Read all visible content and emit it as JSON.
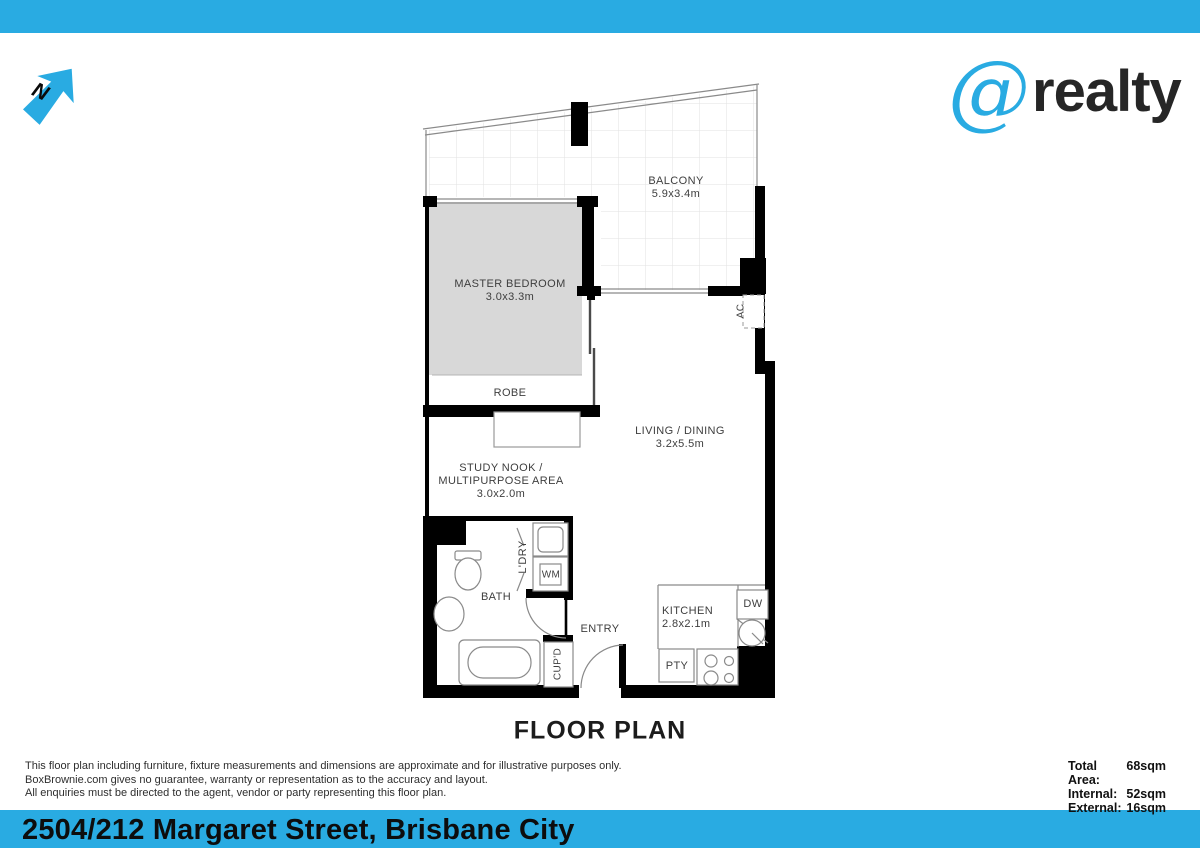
{
  "colors": {
    "brand": "#29abe2",
    "bedroom_fill": "#d8d8d8",
    "wall": "#000000"
  },
  "header": {
    "north_label": "N",
    "logo_at": "@",
    "logo_name": "realty"
  },
  "plan": {
    "title": "FLOOR PLAN",
    "rooms": {
      "balcony": {
        "name": "BALCONY",
        "dims": "5.9x3.4m"
      },
      "master_bedroom": {
        "name": "MASTER BEDROOM",
        "dims": "3.0x3.3m"
      },
      "robe": {
        "name": "ROBE"
      },
      "living_dining": {
        "name": "LIVING / DINING",
        "dims": "3.2x5.5m"
      },
      "study_nook": {
        "name_line1": "STUDY NOOK /",
        "name_line2": "MULTIPURPOSE AREA",
        "dims": "3.0x2.0m"
      },
      "bath": {
        "name": "BATH"
      },
      "laundry": {
        "name": "L'DRY"
      },
      "washing_machine": {
        "name": "WM"
      },
      "entry": {
        "name": "ENTRY"
      },
      "cupboard": {
        "name": "CUP'D"
      },
      "kitchen": {
        "name": "KITCHEN",
        "dims": "2.8x2.1m"
      },
      "pantry": {
        "name": "PTY"
      },
      "dishwasher": {
        "name": "DW"
      },
      "air_conditioner": {
        "name": "AC"
      }
    }
  },
  "footer": {
    "disclaimer_lines": [
      "This floor plan including furniture, fixture measurements and dimensions are approximate and for illustrative purposes only.",
      "BoxBrownie.com gives no guarantee, warranty or representation as to the accuracy and layout.",
      "All enquiries must be directed to the agent, vendor or party representing this floor plan."
    ],
    "areas": [
      {
        "label": "Total Area:",
        "value": "68sqm"
      },
      {
        "label": "Internal:",
        "value": "52sqm"
      },
      {
        "label": "External:",
        "value": "16sqm"
      }
    ]
  },
  "address_bar": {
    "text": "2504/212 Margaret Street, Brisbane City"
  }
}
